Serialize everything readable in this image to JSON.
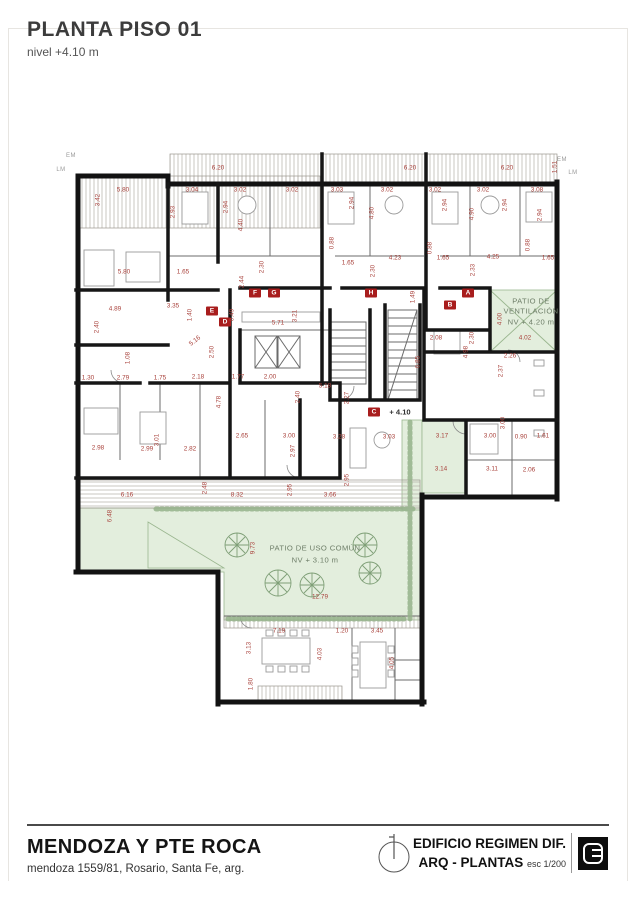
{
  "header": {
    "title": "PLANTA PISO 01",
    "subtitle": "nivel +4.10 m"
  },
  "footer": {
    "project": "MENDOZA Y PTE ROCA",
    "address": "mendoza 1559/81, Rosario, Santa Fe, arg.",
    "building": "EDIFICIO REGIMEN DIF.",
    "sheet": "ARQ - PLANTAS",
    "scale": "esc 1/200",
    "north_icon": "north-arrow",
    "logo_icon": "studio-monogram"
  },
  "plan": {
    "colors": {
      "wall": "#121212",
      "dimension": "#a8403a",
      "marker": "#a81d1d",
      "patio": "#e3eedd"
    },
    "texts": [
      {
        "k": "edge",
        "t": "EM",
        "x": 71,
        "y": 156
      },
      {
        "k": "edge",
        "t": "LM",
        "x": 61,
        "y": 170
      },
      {
        "k": "edge",
        "t": "EM",
        "x": 562,
        "y": 160
      },
      {
        "k": "edge",
        "t": "LM",
        "x": 573,
        "y": 173
      },
      {
        "k": "marker",
        "t": "F",
        "x": 255,
        "y": 293
      },
      {
        "k": "marker",
        "t": "G",
        "x": 274,
        "y": 293
      },
      {
        "k": "marker",
        "t": "H",
        "x": 371,
        "y": 293
      },
      {
        "k": "marker",
        "t": "A",
        "x": 468,
        "y": 293
      },
      {
        "k": "marker",
        "t": "B",
        "x": 450,
        "y": 305
      },
      {
        "k": "marker",
        "t": "E",
        "x": 212,
        "y": 311
      },
      {
        "k": "marker",
        "t": "D",
        "x": 225,
        "y": 322
      },
      {
        "k": "marker",
        "t": "C",
        "x": 374,
        "y": 412
      },
      {
        "k": "level",
        "t": "+ 4.10",
        "x": 400,
        "y": 412
      },
      {
        "k": "patio",
        "t": "PATIO DE",
        "x": 531,
        "y": 301
      },
      {
        "k": "patio",
        "t": "VENTILACIÓN",
        "x": 531,
        "y": 311
      },
      {
        "k": "patio",
        "t": "NV + 4.20 m",
        "x": 531,
        "y": 322
      },
      {
        "k": "patio",
        "t": "PATIO DE USO COMÚN",
        "x": 315,
        "y": 548
      },
      {
        "k": "patio",
        "t": "NV + 3.10 m",
        "x": 315,
        "y": 560
      },
      {
        "t": "6.20",
        "x": 218,
        "y": 168
      },
      {
        "t": "6.20",
        "x": 410,
        "y": 168
      },
      {
        "t": "6.20",
        "x": 507,
        "y": 168
      },
      {
        "t": "5.80",
        "x": 123,
        "y": 190
      },
      {
        "t": "3.04",
        "x": 192,
        "y": 190
      },
      {
        "t": "3.02",
        "x": 240,
        "y": 190
      },
      {
        "t": "3.02",
        "x": 292,
        "y": 190
      },
      {
        "t": "3.03",
        "x": 337,
        "y": 190
      },
      {
        "t": "3.02",
        "x": 387,
        "y": 190
      },
      {
        "t": "3.02",
        "x": 435,
        "y": 190
      },
      {
        "t": "3.02",
        "x": 483,
        "y": 190
      },
      {
        "t": "3.08",
        "x": 537,
        "y": 190
      },
      {
        "t": "5.80",
        "x": 124,
        "y": 272
      },
      {
        "t": "1.65",
        "x": 183,
        "y": 272
      },
      {
        "t": "1.65",
        "x": 348,
        "y": 263
      },
      {
        "t": "1.65",
        "x": 443,
        "y": 258
      },
      {
        "t": "1.65",
        "x": 548,
        "y": 258
      },
      {
        "t": "4.23",
        "x": 395,
        "y": 258
      },
      {
        "t": "4.25",
        "x": 493,
        "y": 257
      },
      {
        "t": "4.89",
        "x": 115,
        "y": 309
      },
      {
        "t": "3.35",
        "x": 173,
        "y": 306
      },
      {
        "t": "5.71",
        "x": 278,
        "y": 323
      },
      {
        "t": "5.16",
        "x": 195,
        "y": 341,
        "r": -38
      },
      {
        "t": "1.30",
        "x": 88,
        "y": 378
      },
      {
        "t": "2.79",
        "x": 123,
        "y": 378
      },
      {
        "t": "1.75",
        "x": 160,
        "y": 378
      },
      {
        "t": "2.18",
        "x": 198,
        "y": 377
      },
      {
        "t": "1.77",
        "x": 238,
        "y": 377
      },
      {
        "t": "2.00",
        "x": 270,
        "y": 377
      },
      {
        "t": "2.65",
        "x": 242,
        "y": 436
      },
      {
        "t": "3.00",
        "x": 289,
        "y": 436
      },
      {
        "t": "3.28",
        "x": 339,
        "y": 437
      },
      {
        "t": "5.18",
        "x": 325,
        "y": 386
      },
      {
        "t": "2.08",
        "x": 436,
        "y": 338
      },
      {
        "t": "4.02",
        "x": 525,
        "y": 338
      },
      {
        "t": "2.26",
        "x": 510,
        "y": 356
      },
      {
        "t": "2.98",
        "x": 98,
        "y": 448
      },
      {
        "t": "2.99",
        "x": 147,
        "y": 449
      },
      {
        "t": "2.82",
        "x": 190,
        "y": 449
      },
      {
        "t": "3.03",
        "x": 389,
        "y": 437
      },
      {
        "t": "3.17",
        "x": 442,
        "y": 436
      },
      {
        "t": "3.00",
        "x": 490,
        "y": 436
      },
      {
        "t": "0.90",
        "x": 521,
        "y": 437
      },
      {
        "t": "1.61",
        "x": 543,
        "y": 436
      },
      {
        "t": "3.14",
        "x": 441,
        "y": 469
      },
      {
        "t": "3.11",
        "x": 492,
        "y": 469
      },
      {
        "t": "2.06",
        "x": 529,
        "y": 470
      },
      {
        "t": "6.16",
        "x": 127,
        "y": 495
      },
      {
        "t": "8.32",
        "x": 237,
        "y": 495
      },
      {
        "t": "3.66",
        "x": 330,
        "y": 495
      },
      {
        "t": "12.79",
        "x": 320,
        "y": 597
      },
      {
        "t": "7.19",
        "x": 279,
        "y": 631
      },
      {
        "t": "1.20",
        "x": 342,
        "y": 631
      },
      {
        "t": "3.45",
        "x": 377,
        "y": 631
      },
      {
        "t": "3.42",
        "x": 98,
        "y": 200,
        "r": -90
      },
      {
        "t": "2.93",
        "x": 173,
        "y": 212,
        "r": -90
      },
      {
        "t": "2.94",
        "x": 226,
        "y": 207,
        "r": -90
      },
      {
        "t": "4.40",
        "x": 241,
        "y": 225,
        "r": -90
      },
      {
        "t": "1.51",
        "x": 555,
        "y": 167,
        "r": -90
      },
      {
        "t": "2.94",
        "x": 352,
        "y": 203,
        "r": -90
      },
      {
        "t": "4.80",
        "x": 372,
        "y": 213,
        "r": -90
      },
      {
        "t": "2.94",
        "x": 445,
        "y": 205,
        "r": -90
      },
      {
        "t": "4.90",
        "x": 472,
        "y": 214,
        "r": -90
      },
      {
        "t": "2.94",
        "x": 505,
        "y": 205,
        "r": -90
      },
      {
        "t": "2.94",
        "x": 540,
        "y": 215,
        "r": -90
      },
      {
        "t": "0.88",
        "x": 332,
        "y": 243,
        "r": -90
      },
      {
        "t": "0.88",
        "x": 430,
        "y": 248,
        "r": -90
      },
      {
        "t": "0.88",
        "x": 528,
        "y": 245,
        "r": -90
      },
      {
        "t": "2.30",
        "x": 262,
        "y": 267,
        "r": -90
      },
      {
        "t": "2.30",
        "x": 373,
        "y": 271,
        "r": -90
      },
      {
        "t": "2.33",
        "x": 473,
        "y": 270,
        "r": -90
      },
      {
        "t": "2.44",
        "x": 242,
        "y": 282,
        "r": -90
      },
      {
        "t": "2.40",
        "x": 97,
        "y": 327,
        "r": -90
      },
      {
        "t": "1.40",
        "x": 190,
        "y": 315,
        "r": -90
      },
      {
        "t": "0.49",
        "x": 232,
        "y": 315,
        "r": -90
      },
      {
        "t": "3.21",
        "x": 295,
        "y": 316,
        "r": -90
      },
      {
        "t": "1.49",
        "x": 413,
        "y": 297,
        "r": -90
      },
      {
        "t": "2.50",
        "x": 212,
        "y": 352,
        "r": -90
      },
      {
        "t": "1.08",
        "x": 128,
        "y": 358,
        "r": -90
      },
      {
        "t": "6.85",
        "x": 418,
        "y": 362,
        "r": -90
      },
      {
        "t": "2.30",
        "x": 472,
        "y": 338,
        "r": -90
      },
      {
        "t": "4.98",
        "x": 466,
        "y": 352,
        "r": -90
      },
      {
        "t": "4.00",
        "x": 500,
        "y": 319,
        "r": -90
      },
      {
        "t": "2.37",
        "x": 501,
        "y": 371,
        "r": -90
      },
      {
        "t": "4.78",
        "x": 219,
        "y": 402,
        "r": -90
      },
      {
        "t": "2.40",
        "x": 298,
        "y": 397,
        "r": -90
      },
      {
        "t": "2.27",
        "x": 347,
        "y": 398,
        "r": -90
      },
      {
        "t": "2.97",
        "x": 293,
        "y": 451,
        "r": -90
      },
      {
        "t": "3.01",
        "x": 157,
        "y": 440,
        "r": -90
      },
      {
        "t": "2.95",
        "x": 347,
        "y": 480,
        "r": -90
      },
      {
        "t": "3.00",
        "x": 503,
        "y": 423,
        "r": -90
      },
      {
        "t": "9.73",
        "x": 253,
        "y": 548,
        "r": -90
      },
      {
        "t": "6.48",
        "x": 110,
        "y": 516,
        "r": -90
      },
      {
        "t": "2.48",
        "x": 205,
        "y": 488,
        "r": -90
      },
      {
        "t": "2.95",
        "x": 290,
        "y": 490,
        "r": -90
      },
      {
        "t": "3.13",
        "x": 249,
        "y": 648,
        "r": -90
      },
      {
        "t": "4.03",
        "x": 320,
        "y": 654,
        "r": -90
      },
      {
        "t": "1.80",
        "x": 251,
        "y": 684,
        "r": -90
      },
      {
        "t": "4.05",
        "x": 392,
        "y": 663,
        "r": -90
      }
    ]
  }
}
